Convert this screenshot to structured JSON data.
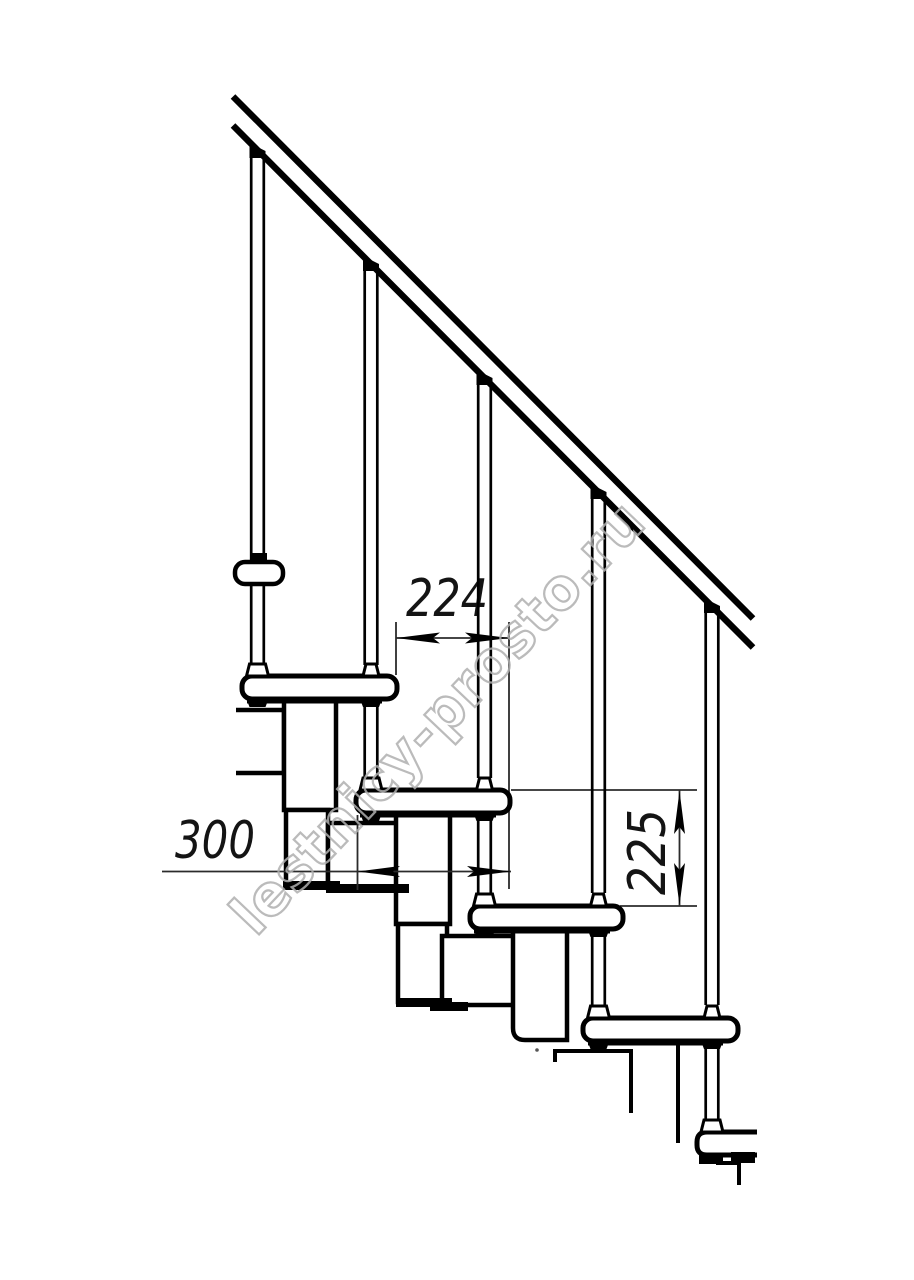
{
  "drawing": {
    "title": "Modular staircase side view technical drawing",
    "background": "#ffffff",
    "line_color": "#000000",
    "thin_line_color": "#2b2b2b",
    "dim_text_color": "#141414",
    "dimensions": {
      "step_offset": "224",
      "step_depth": "300",
      "step_rise": "225"
    },
    "watermark": {
      "text": "lestnicy-prosto.ru",
      "color": "#b0b0b0",
      "rotation_deg": -46.5
    }
  }
}
